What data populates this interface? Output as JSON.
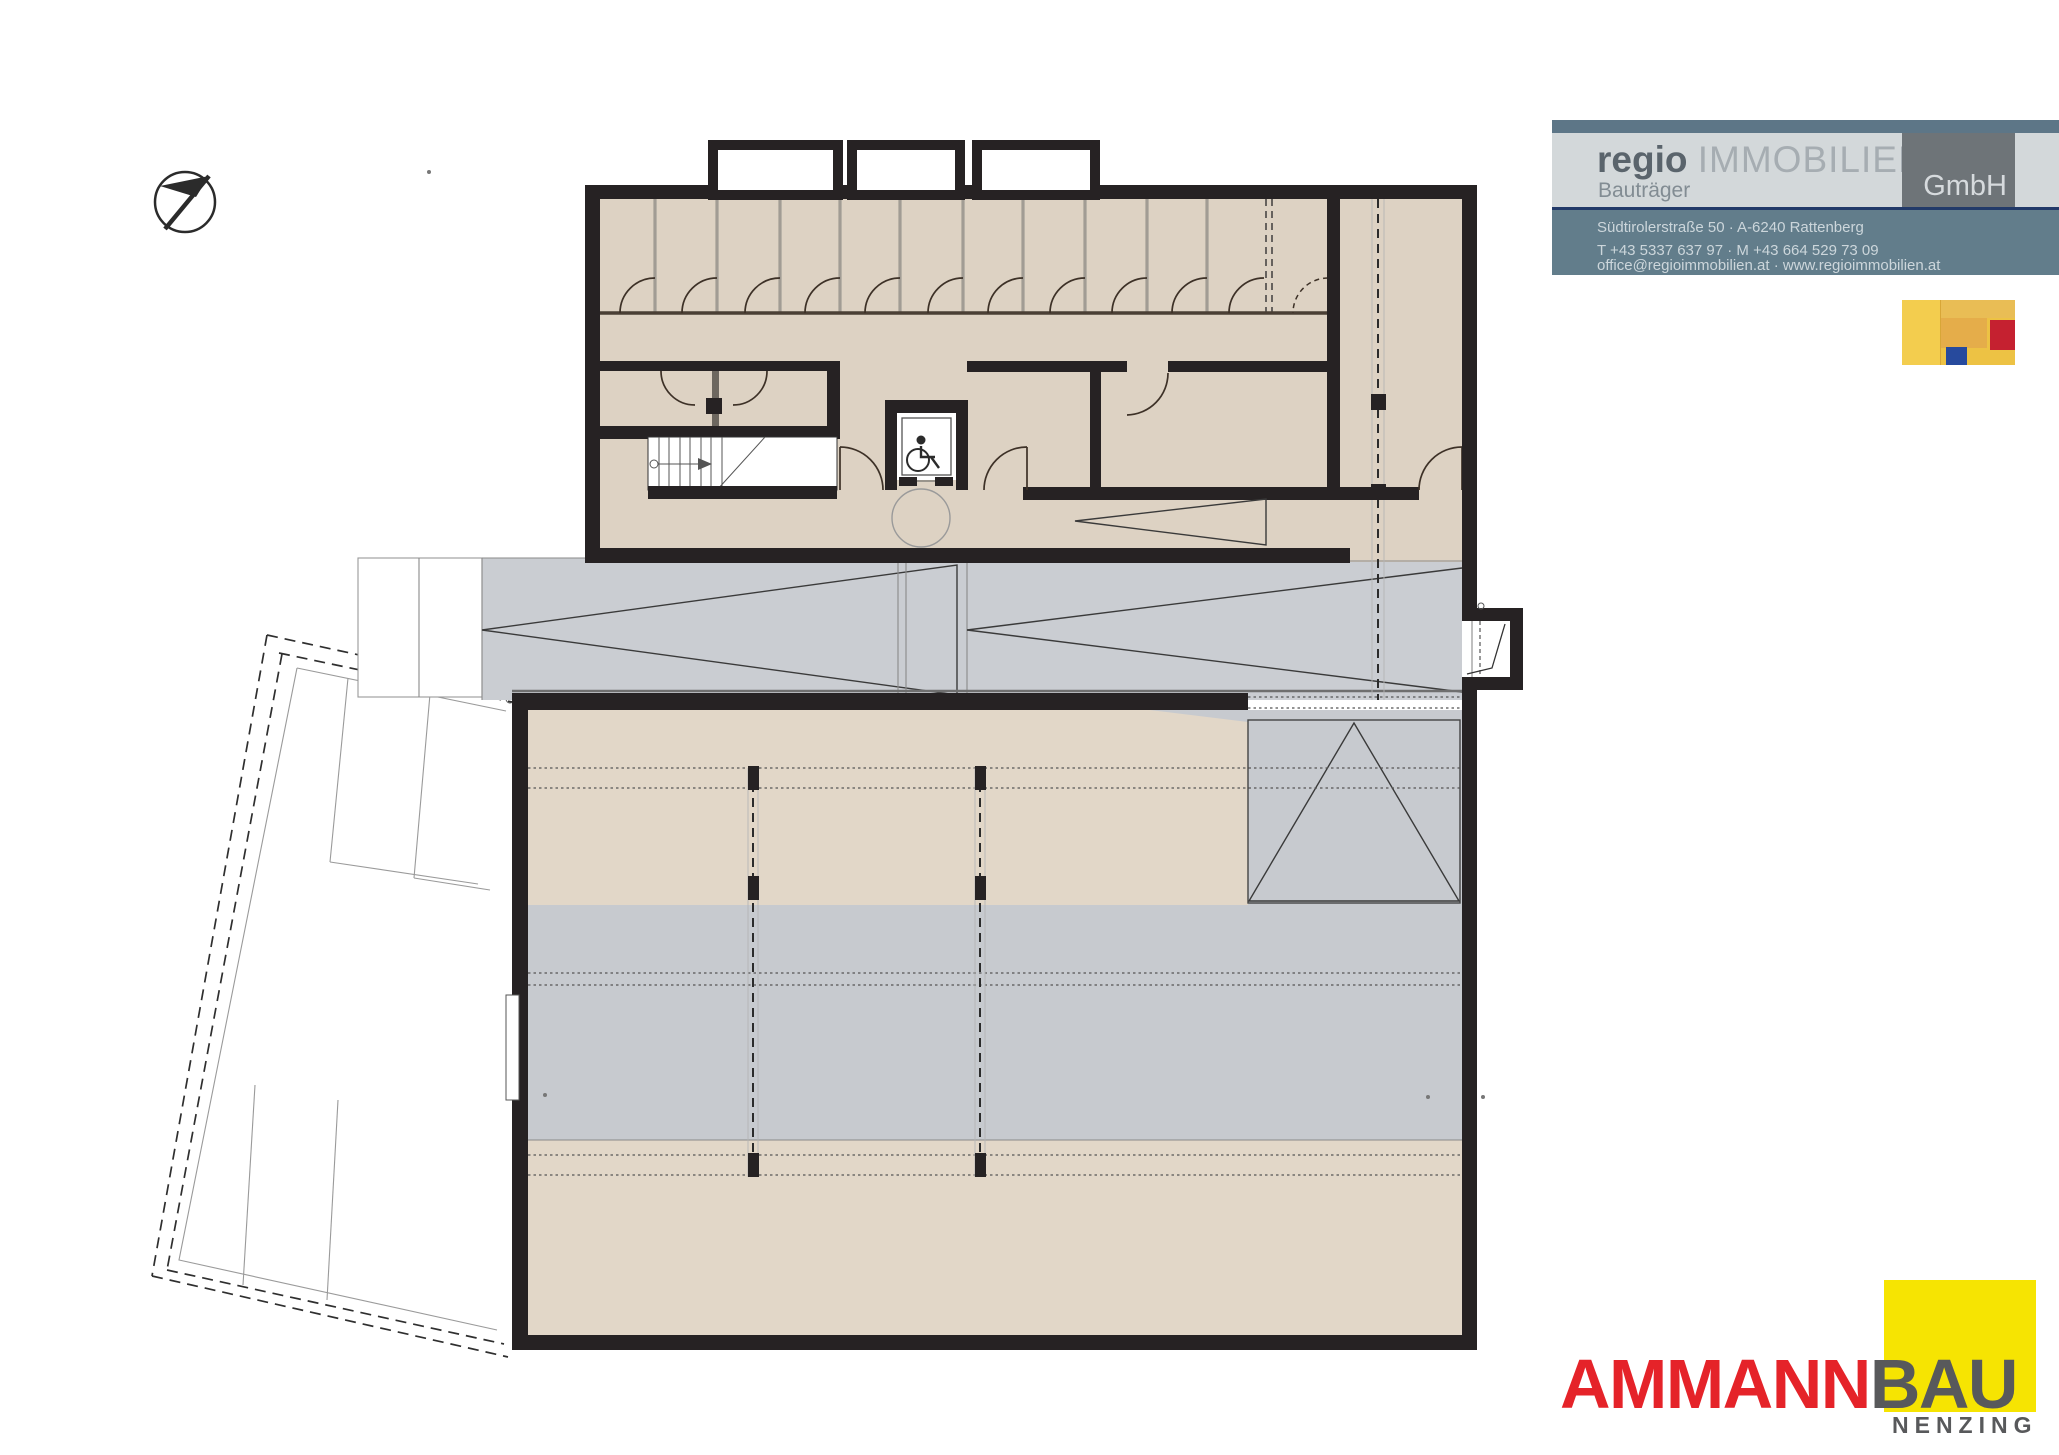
{
  "colors": {
    "wall": "#262223",
    "plan_beige": "#ddd2c3",
    "plan_beige2": "#e2d7c8",
    "plan_gray": "#cacdd2",
    "plan_gray2": "#c7cacf",
    "regio_strip": "#5d7687",
    "regio_band": "#d3d8da",
    "regio_band_dark": "#627d8b",
    "regio_divider": "#223a69",
    "regio_gmbh_box": "#6e7478",
    "regio_text_dark": "#5a646c",
    "regio_text_light": "#a6adb2",
    "regio_text_sub": "#828c93",
    "regio_text_contact": "#ccd6db",
    "art_yellow": "#edc244",
    "art_yellow2": "#f3cd4e",
    "art_amber": "#e9bd55",
    "art_orange": "#e5ad4a",
    "art_red": "#c52130",
    "art_blue": "#274a9d",
    "ammann_red": "#e52329",
    "ammann_gray": "#58595b",
    "ammann_yellow": "#f6e402"
  },
  "regio_logo": {
    "brand_bold": "regio",
    "brand_light": "IMMOBILIEN",
    "subtitle": "Bauträger",
    "gmbh": "GmbH",
    "address": "Südtirolerstraße 50 · A-6240 Rattenberg",
    "phones": "T  +43 5337 637 97 · M  +43 664 529 73 09",
    "web": "office@regioimmobilien.at · www.regioimmobilien.at"
  },
  "ammann_logo": {
    "name_red": "AMMANN",
    "name_gray": "BAU",
    "city": "NENZING"
  }
}
